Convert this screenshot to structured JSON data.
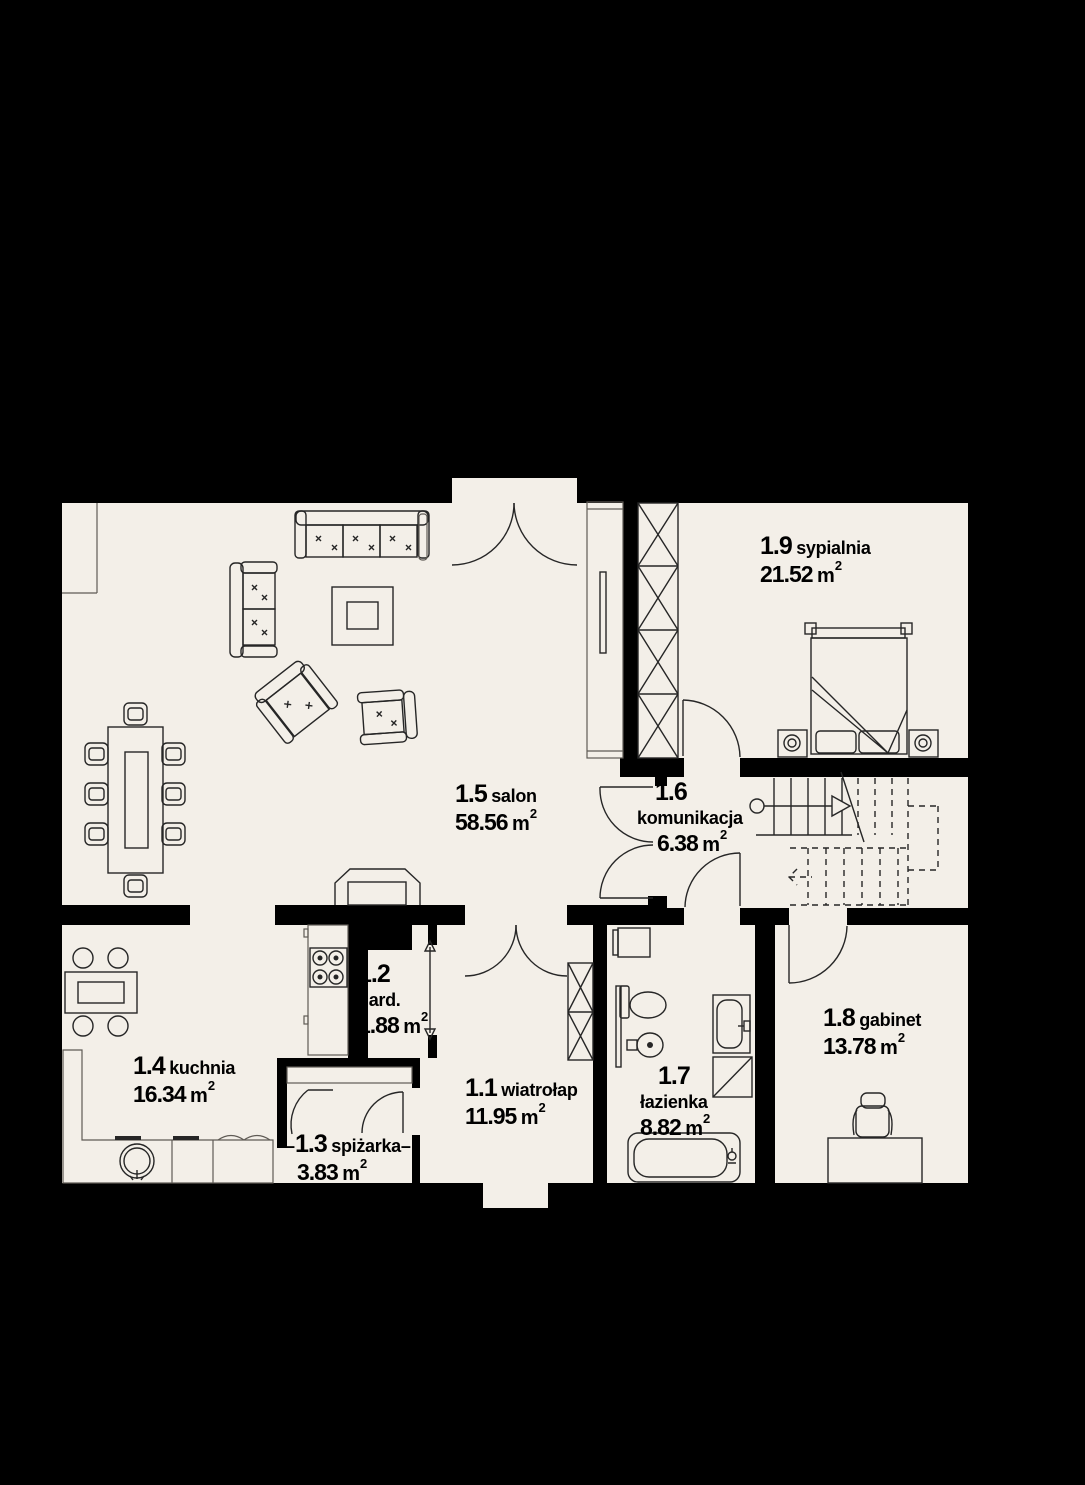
{
  "meta": {
    "sup": "2"
  },
  "colors": {
    "background": "#000000",
    "wall": "#000000",
    "room_fill": "#f3efe8",
    "line": "#262626"
  },
  "rooms": [
    {
      "number": "1.1",
      "name": "wiatrołap",
      "area": "11.95",
      "unit": "m"
    },
    {
      "number": "1.2",
      "name": "gard.",
      "area": "1.88",
      "unit": "m"
    },
    {
      "number": "1.3",
      "name": "spiżarka",
      "area": "3.83",
      "unit": "m",
      "dash": "–"
    },
    {
      "number": "1.4",
      "name": "kuchnia",
      "area": "16.34",
      "unit": "m"
    },
    {
      "number": "1.5",
      "name": "salon",
      "area": "58.56",
      "unit": "m"
    },
    {
      "number": "1.6",
      "name": "komunikacja",
      "area": "6.38",
      "unit": "m"
    },
    {
      "number": "1.7",
      "name": "łazienka",
      "area": "8.82",
      "unit": "m"
    },
    {
      "number": "1.8",
      "name": "gabinet",
      "area": "13.78",
      "unit": "m"
    },
    {
      "number": "1.9",
      "name": "sypialnia",
      "area": "21.52",
      "unit": "m"
    }
  ],
  "furniture_icons": [
    "sofa-3-seat",
    "sofa-2-seat",
    "coffee-table",
    "armchair",
    "armchair-2",
    "dining-table-8-chairs",
    "tv-cabinet",
    "fireplace",
    "radiator",
    "kitchen-table-4-chairs",
    "kitchen-counter-sink",
    "stove-4-burners",
    "pantry-shelf",
    "entry-wardrobe",
    "bedroom-wardrobe",
    "double-bed",
    "nightstand-lamp",
    "nightstand-lamp-2",
    "washing-machine",
    "toilet",
    "bidet",
    "washbasin",
    "shower",
    "bathtub",
    "desk",
    "office-chair",
    "staircase"
  ]
}
